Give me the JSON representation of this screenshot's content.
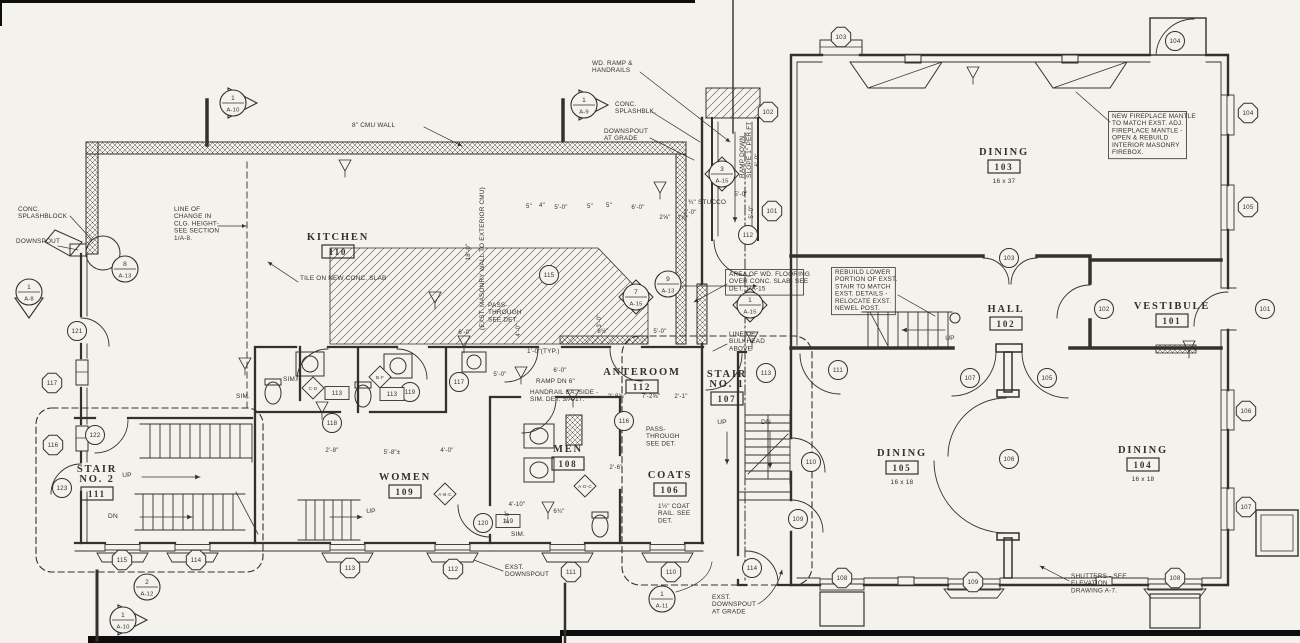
{
  "drawing": {
    "type": "architectural-floor-plan",
    "paper": "#f3f2ec",
    "ink": "#33312c"
  },
  "rooms": [
    {
      "id": "kitchen",
      "lines": [
        "KITCHEN"
      ],
      "number": "110",
      "x": 338,
      "y": 240
    },
    {
      "id": "dining-103",
      "lines": [
        "DINING"
      ],
      "number": "103",
      "size": "16 x 37",
      "x": 1004,
      "y": 155
    },
    {
      "id": "hall",
      "lines": [
        "HALL"
      ],
      "number": "102",
      "x": 1006,
      "y": 312
    },
    {
      "id": "vestibule",
      "lines": [
        "VESTIBULE"
      ],
      "number": "101",
      "x": 1172,
      "y": 309
    },
    {
      "id": "dining-105",
      "lines": [
        "DINING"
      ],
      "number": "105",
      "size": "16 x 18",
      "x": 902,
      "y": 456
    },
    {
      "id": "dining-104",
      "lines": [
        "DINING"
      ],
      "number": "104",
      "size": "16 x 18",
      "x": 1143,
      "y": 453
    },
    {
      "id": "anteroom",
      "lines": [
        "ANTEROOM"
      ],
      "number": "112",
      "x": 642,
      "y": 375
    },
    {
      "id": "stair-1",
      "lines": [
        "STAIR",
        "NO. 1"
      ],
      "number": "107",
      "x": 727,
      "y": 377
    },
    {
      "id": "women",
      "lines": [
        "WOMEN"
      ],
      "number": "109",
      "x": 405,
      "y": 480
    },
    {
      "id": "men",
      "lines": [
        "MEN"
      ],
      "number": "108",
      "x": 568,
      "y": 452
    },
    {
      "id": "coats",
      "lines": [
        "COATS"
      ],
      "number": "106",
      "x": 670,
      "y": 478
    },
    {
      "id": "stair-2",
      "lines": [
        "STAIR",
        "NO. 2"
      ],
      "number": "111",
      "x": 97,
      "y": 472
    }
  ],
  "window_tags": [
    {
      "label": "117",
      "x": 52,
      "y": 383
    },
    {
      "label": "116",
      "x": 53,
      "y": 445
    },
    {
      "label": "115",
      "x": 122,
      "y": 560
    },
    {
      "label": "114",
      "x": 196,
      "y": 560
    },
    {
      "label": "113",
      "x": 350,
      "y": 568
    },
    {
      "label": "112",
      "x": 453,
      "y": 569
    },
    {
      "label": "111",
      "x": 571,
      "y": 572
    },
    {
      "label": "110",
      "x": 671,
      "y": 572
    },
    {
      "label": "103",
      "x": 841,
      "y": 37
    },
    {
      "label": "104",
      "x": 1248,
      "y": 113
    },
    {
      "label": "105",
      "x": 1248,
      "y": 207
    },
    {
      "label": "106",
      "x": 1246,
      "y": 411
    },
    {
      "label": "107",
      "x": 1246,
      "y": 507
    },
    {
      "label": "109",
      "x": 973,
      "y": 582
    },
    {
      "label": "108",
      "x": 1175,
      "y": 578
    },
    {
      "label": "108",
      "x": 842,
      "y": 578
    },
    {
      "label": "102",
      "x": 768,
      "y": 112
    },
    {
      "label": "101",
      "x": 772,
      "y": 211
    }
  ],
  "door_tags": [
    {
      "label": "104",
      "x": 1175,
      "y": 41
    },
    {
      "label": "103",
      "x": 1009,
      "y": 258
    },
    {
      "label": "102",
      "x": 1104,
      "y": 309
    },
    {
      "label": "101",
      "x": 1265,
      "y": 309
    },
    {
      "label": "107",
      "x": 970,
      "y": 378
    },
    {
      "label": "105",
      "x": 1047,
      "y": 378
    },
    {
      "label": "106",
      "x": 1009,
      "y": 459
    },
    {
      "label": "111",
      "x": 838,
      "y": 370
    },
    {
      "label": "113",
      "x": 766,
      "y": 373
    },
    {
      "label": "109",
      "x": 798,
      "y": 519
    },
    {
      "label": "110",
      "x": 811,
      "y": 462
    },
    {
      "label": "114",
      "x": 752,
      "y": 568
    },
    {
      "label": "112",
      "x": 748,
      "y": 235
    },
    {
      "label": "116",
      "x": 624,
      "y": 421
    },
    {
      "label": "117",
      "x": 459,
      "y": 382
    },
    {
      "label": "118",
      "x": 332,
      "y": 423
    },
    {
      "label": "119",
      "x": 410,
      "y": 392
    },
    {
      "label": "120",
      "x": 483,
      "y": 523
    },
    {
      "label": "121",
      "x": 77,
      "y": 331
    },
    {
      "label": "122",
      "x": 95,
      "y": 435
    },
    {
      "label": "123",
      "x": 62,
      "y": 488
    },
    {
      "label": "115",
      "x": 549,
      "y": 275
    }
  ],
  "detail_tags": [
    {
      "top": "1",
      "bottom": "A-10",
      "x": 233,
      "y": 103,
      "shape": "flag-right"
    },
    {
      "top": "1",
      "bottom": "A-9",
      "x": 584,
      "y": 105,
      "shape": "flag-right"
    },
    {
      "top": "1",
      "bottom": "A-8",
      "x": 29,
      "y": 292,
      "shape": "flag-down"
    },
    {
      "top": "1",
      "bottom": "A-10",
      "x": 123,
      "y": 620,
      "shape": "flag-right"
    },
    {
      "top": "2",
      "bottom": "A-12",
      "x": 147,
      "y": 587,
      "shape": "circle"
    },
    {
      "top": "1",
      "bottom": "A-11",
      "x": 662,
      "y": 599,
      "shape": "circle"
    },
    {
      "top": "8",
      "bottom": "A-13",
      "x": 125,
      "y": 269,
      "shape": "circle"
    },
    {
      "top": "9",
      "bottom": "A-13",
      "x": 668,
      "y": 284,
      "shape": "circle"
    },
    {
      "top": "3",
      "bottom": "A-15",
      "x": 722,
      "y": 174,
      "shape": "diamond"
    },
    {
      "top": "1",
      "bottom": "A-15",
      "x": 750,
      "y": 305,
      "shape": "diamond"
    },
    {
      "top": "7",
      "bottom": "A-15",
      "x": 636,
      "y": 297,
      "shape": "diamond"
    }
  ],
  "fixture_tags": [
    {
      "label": "113",
      "x": 337,
      "y": 393
    },
    {
      "label": "113",
      "x": 392,
      "y": 394
    },
    {
      "label": "119",
      "x": 508,
      "y": 521
    }
  ],
  "letter_tags": [
    {
      "label": "C·D",
      "x": 313,
      "y": 388
    },
    {
      "label": "B·F",
      "x": 380,
      "y": 377
    },
    {
      "label": "A·B·C",
      "x": 445,
      "y": 494
    },
    {
      "label": "A·D·C",
      "x": 585,
      "y": 486
    }
  ],
  "annotations": [
    {
      "id": "cmu-wall",
      "lines": [
        "8\" CMU WALL"
      ],
      "x": 352,
      "y": 127
    },
    {
      "id": "conc-splashblock",
      "lines": [
        "CONC.",
        "SPLASHBLOCK"
      ],
      "x": 18,
      "y": 211
    },
    {
      "id": "downspout",
      "lines": [
        "DOWNSPOUT"
      ],
      "x": 16,
      "y": 243
    },
    {
      "id": "clg-height",
      "lines": [
        "LINE OF",
        "CHANGE IN",
        "CLG. HEIGHT-",
        "SEE SECTION",
        "1/A-8."
      ],
      "x": 174,
      "y": 211
    },
    {
      "id": "tile-slab",
      "lines": [
        "TILE ON NEW CONC. SLAB"
      ],
      "x": 300,
      "y": 280
    },
    {
      "id": "wd-ramp",
      "lines": [
        "WD. RAMP &",
        "HANDRAILS"
      ],
      "x": 592,
      "y": 65
    },
    {
      "id": "conc-splashblk",
      "lines": [
        "CONC.",
        "SPLASHBLK."
      ],
      "x": 615,
      "y": 106
    },
    {
      "id": "downspout-grade",
      "lines": [
        "DOWNSPOUT",
        "AT GRADE"
      ],
      "x": 604,
      "y": 133
    },
    {
      "id": "stucco",
      "lines": [
        "¾\" STUCCO"
      ],
      "x": 688,
      "y": 204
    },
    {
      "id": "ramp-down",
      "lines": [
        "RAMP DOWN",
        "SLOPE 1\" PER FT"
      ],
      "x": 744,
      "y": 178,
      "rotate": -90
    },
    {
      "id": "wd-flooring",
      "lines": [
        "AREA OF WD. FLOORING",
        "OVER CONC. SLAB- SEE",
        "DET. 1/A-15"
      ],
      "x": 729,
      "y": 276,
      "boxed": true
    },
    {
      "id": "rebuild-stair",
      "lines": [
        "REBUILD LOWER",
        "PORTION OF EXST.",
        "STAIR TO MATCH",
        "EXST. DETAILS -",
        "RELOCATE EXST.",
        "NEWEL POST."
      ],
      "x": 835,
      "y": 274,
      "boxed": true
    },
    {
      "id": "fireplace",
      "lines": [
        "NEW FIREPLACE MANTLE",
        "TO MATCH EXST. ADJ.",
        "FIREPLACE MANTLE -",
        "OPEN & REBUILD",
        "INTERIOR MASONRY",
        "FIREBOX."
      ],
      "x": 1112,
      "y": 118,
      "boxed": true
    },
    {
      "id": "bulkhead",
      "lines": [
        "LINE OF",
        "BULKHEAD",
        "ABOVE"
      ],
      "x": 729,
      "y": 336
    },
    {
      "id": "pass-through-1",
      "lines": [
        "PASS-",
        "THROUGH",
        "SEE DET."
      ],
      "x": 488,
      "y": 307
    },
    {
      "id": "pass-through-2",
      "lines": [
        "PASS-",
        "THROUGH",
        "SEE DET."
      ],
      "x": 646,
      "y": 431
    },
    {
      "id": "coat-rail",
      "lines": [
        "1½\" COAT",
        "RAIL. SEE",
        "DET."
      ],
      "x": 658,
      "y": 508
    },
    {
      "id": "ramp-dn",
      "lines": [
        "RAMP DN 6\""
      ],
      "x": 536,
      "y": 383
    },
    {
      "id": "handrail",
      "lines": [
        "HANDRAIL EA. SIDE -",
        "SIM. DET. 3/A-17."
      ],
      "x": 530,
      "y": 394
    },
    {
      "id": "typ-dim",
      "lines": [
        "1'-0\"(TYP.)"
      ],
      "x": 527,
      "y": 353
    },
    {
      "id": "exst-downspout",
      "lines": [
        "EXST.",
        "DOWNSPOUT"
      ],
      "x": 505,
      "y": 569
    },
    {
      "id": "exst-downspout-grade",
      "lines": [
        "EXST.",
        "DOWNSPOUT",
        "AT GRADE"
      ],
      "x": 712,
      "y": 599
    },
    {
      "id": "shutters",
      "lines": [
        "SHUTTERS - SEE",
        "ELEVATION",
        "DRAWING A-7."
      ],
      "x": 1071,
      "y": 578
    },
    {
      "id": "masonry-wall",
      "lines": [
        "(EXST. MASONRY WALL TO EXTERIOR CMU)"
      ],
      "x": 484,
      "y": 330,
      "rotate": -90
    },
    {
      "id": "sim-1",
      "lines": [
        "SIM."
      ],
      "x": 283,
      "y": 381
    },
    {
      "id": "sim-2",
      "lines": [
        "SIM."
      ],
      "x": 236,
      "y": 398
    },
    {
      "id": "sim-3",
      "lines": [
        "SIM."
      ],
      "x": 511,
      "y": 536
    }
  ],
  "dimensions": [
    {
      "text": "5\"",
      "x": 529,
      "y": 208
    },
    {
      "text": "4\"",
      "x": 542,
      "y": 207
    },
    {
      "text": "5'-0\"",
      "x": 561,
      "y": 209
    },
    {
      "text": "5\"",
      "x": 590,
      "y": 208
    },
    {
      "text": "5\"",
      "x": 609,
      "y": 207
    },
    {
      "text": "6'-0\"",
      "x": 638,
      "y": 209
    },
    {
      "text": "2'-0\"",
      "x": 690,
      "y": 214
    },
    {
      "text": "2⅝\"",
      "x": 665,
      "y": 219
    },
    {
      "text": "7⅞\"",
      "x": 683,
      "y": 220
    },
    {
      "text": "5'-0\"",
      "x": 741,
      "y": 196
    },
    {
      "text": "6'-0\"",
      "x": 759,
      "y": 160,
      "rotate": -90
    },
    {
      "text": "5'-0\"",
      "x": 753,
      "y": 212,
      "rotate": -90
    },
    {
      "text": "6'-0\"",
      "x": 465,
      "y": 334
    },
    {
      "text": "5'-0\"",
      "x": 500,
      "y": 376
    },
    {
      "text": "6'-0\"",
      "x": 560,
      "y": 372
    },
    {
      "text": "2'-8⅝\"",
      "x": 617,
      "y": 398
    },
    {
      "text": "7'-2⅝\"",
      "x": 651,
      "y": 398
    },
    {
      "text": "2'-1\"",
      "x": 681,
      "y": 398
    },
    {
      "text": "5'-0\"",
      "x": 660,
      "y": 333
    },
    {
      "text": "2'-8\"",
      "x": 332,
      "y": 452
    },
    {
      "text": "5'-8\"±",
      "x": 392,
      "y": 454
    },
    {
      "text": "4'-0\"",
      "x": 447,
      "y": 452
    },
    {
      "text": "4'-10\"",
      "x": 517,
      "y": 506
    },
    {
      "text": "6¾\"",
      "x": 559,
      "y": 513
    },
    {
      "text": "2'-6\"",
      "x": 616,
      "y": 469
    },
    {
      "text": "8½\"",
      "x": 603,
      "y": 333
    },
    {
      "text": "4'-0\"",
      "x": 520,
      "y": 330,
      "rotate": -90
    },
    {
      "text": "3'-0\"",
      "x": 601,
      "y": 321,
      "rotate": -90
    },
    {
      "text": "3'-0\"",
      "x": 509,
      "y": 517,
      "rotate": -90
    },
    {
      "text": "18'-0\"",
      "x": 470,
      "y": 252,
      "rotate": -90
    }
  ],
  "stair_labels": [
    {
      "text": "UP",
      "x": 127,
      "y": 477
    },
    {
      "text": "DN",
      "x": 113,
      "y": 518
    },
    {
      "text": "UP",
      "x": 371,
      "y": 513
    },
    {
      "text": "UP",
      "x": 722,
      "y": 424
    },
    {
      "text": "DN",
      "x": 766,
      "y": 424
    },
    {
      "text": "UP",
      "x": 950,
      "y": 340
    }
  ]
}
